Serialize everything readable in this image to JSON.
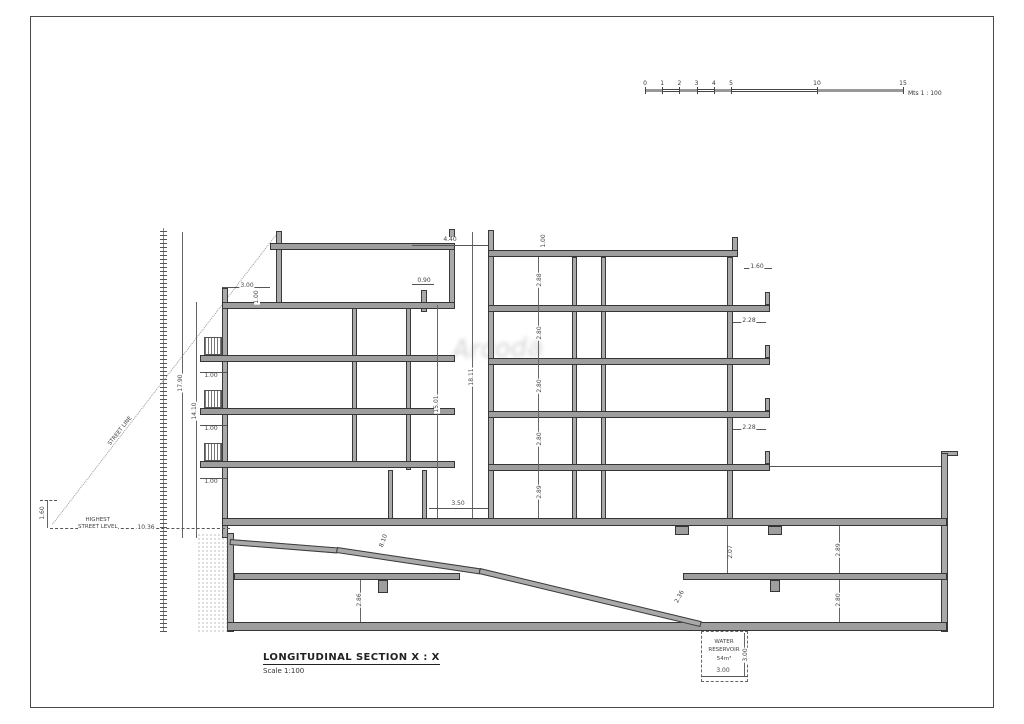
{
  "title_block": {
    "title": "LONGITUDINAL SECTION X : X",
    "subtitle": "Scale 1:100"
  },
  "scale_bar": {
    "unit_label": "Mts 1 : 100",
    "px_per_meter": 17.2,
    "ticks": [
      {
        "label": "0",
        "m": 0
      },
      {
        "label": "1",
        "m": 1
      },
      {
        "label": "2",
        "m": 2
      },
      {
        "label": "3",
        "m": 3
      },
      {
        "label": "4",
        "m": 4
      },
      {
        "label": "5",
        "m": 5
      },
      {
        "label": "10",
        "m": 10
      },
      {
        "label": "15",
        "m": 15
      }
    ],
    "filled_segments": [
      [
        0,
        1
      ],
      [
        2,
        3
      ],
      [
        4,
        5
      ],
      [
        10,
        15
      ]
    ]
  },
  "labels": {
    "street_line": "STREET LINE",
    "highest_line1": "HIGHEST",
    "highest_line2": "STREET LEVEL",
    "reservoir_line1": "WATER",
    "reservoir_line2": "RESERVOIR",
    "reservoir_line3": "54m³"
  },
  "watermark": "Arcoda",
  "colors": {
    "wall_fill": "#a9a9a9",
    "outline": "#3a3a3a",
    "dim_text": "#444444",
    "background": "#ffffff"
  },
  "dimensions": [
    {
      "t": "4.40",
      "x": 450,
      "y": 240,
      "r": 0
    },
    {
      "t": "0.90",
      "x": 424,
      "y": 281,
      "r": 0
    },
    {
      "t": "1.00",
      "x": 544,
      "y": 241,
      "r": -90
    },
    {
      "t": "3.00",
      "x": 247,
      "y": 286,
      "r": 0
    },
    {
      "t": "1.00",
      "x": 257,
      "y": 297,
      "r": -90
    },
    {
      "t": "1.60",
      "x": 757,
      "y": 267,
      "r": 0
    },
    {
      "t": "2.28",
      "x": 749,
      "y": 321,
      "r": 0
    },
    {
      "t": "2.28",
      "x": 749,
      "y": 428,
      "r": 0
    },
    {
      "t": "2.88",
      "x": 540,
      "y": 280,
      "r": -90
    },
    {
      "t": "2.80",
      "x": 540,
      "y": 333,
      "r": -90
    },
    {
      "t": "2.80",
      "x": 540,
      "y": 386,
      "r": -90
    },
    {
      "t": "2.80",
      "x": 540,
      "y": 439,
      "r": -90
    },
    {
      "t": "2.89",
      "x": 540,
      "y": 492,
      "r": -90
    },
    {
      "t": "15.01",
      "x": 437,
      "y": 404,
      "r": -90
    },
    {
      "t": "18.11",
      "x": 472,
      "y": 377,
      "r": -90
    },
    {
      "t": "17.90",
      "x": 181,
      "y": 383,
      "r": -90
    },
    {
      "t": "14.10",
      "x": 195,
      "y": 411,
      "r": -90
    },
    {
      "t": "1.00",
      "x": 211,
      "y": 376,
      "r": 0
    },
    {
      "t": "1.00",
      "x": 211,
      "y": 429,
      "r": 0
    },
    {
      "t": "1.00",
      "x": 211,
      "y": 482,
      "r": 0
    },
    {
      "t": "3.50",
      "x": 458,
      "y": 504,
      "r": 0
    },
    {
      "t": "8.10",
      "x": 384,
      "y": 541,
      "r": -70
    },
    {
      "t": "10.36",
      "x": 146,
      "y": 528,
      "r": 0
    },
    {
      "t": "1.60",
      "x": 43,
      "y": 513,
      "r": -90
    },
    {
      "t": "2.36",
      "x": 680,
      "y": 597,
      "r": -62
    },
    {
      "t": "2.07",
      "x": 731,
      "y": 552,
      "r": -90
    },
    {
      "t": "2.89",
      "x": 839,
      "y": 550,
      "r": -90
    },
    {
      "t": "2.80",
      "x": 839,
      "y": 600,
      "r": -90
    },
    {
      "t": "2.86",
      "x": 360,
      "y": 600,
      "r": -90
    },
    {
      "t": "3.00",
      "x": 723,
      "y": 671,
      "r": 0
    },
    {
      "t": "3.00",
      "x": 746,
      "y": 655,
      "r": -90
    }
  ]
}
